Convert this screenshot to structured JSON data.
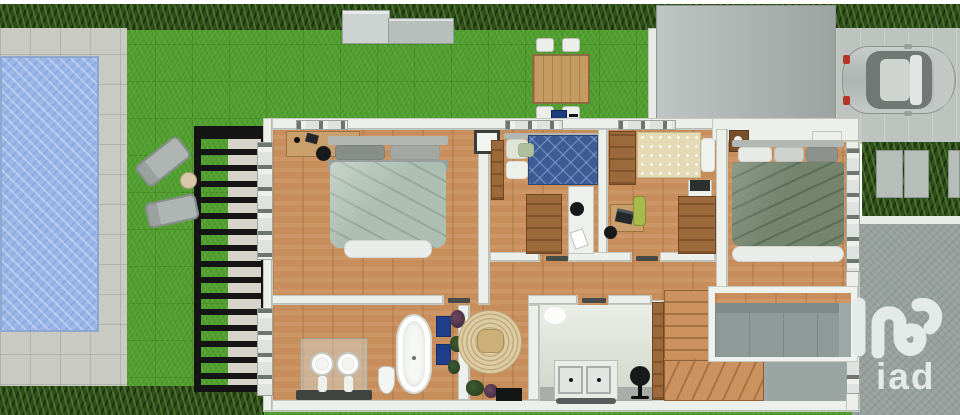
{
  "scene": {
    "kind": "3d-rendered-floor-plan",
    "description": "Top-down 3D render of an upper floor plan with garden, swimming pool, pergola, garden shed, outdoor dining set, garage roof and parked car",
    "floor_rooms": [
      {
        "name": "master-bedroom",
        "features": [
          "double-bed-sage-duvet",
          "desk",
          "black-chair",
          "wall-art",
          "left-windows"
        ]
      },
      {
        "name": "bedroom-blue",
        "features": [
          "single-bed-blue-diamond-duvet",
          "wardrobes",
          "white-desk",
          "black-chair"
        ]
      },
      {
        "name": "bedroom-beige",
        "features": [
          "single-bed-dotted-duvet",
          "wardrobes",
          "laptop",
          "green-chair",
          "nightstand"
        ]
      },
      {
        "name": "bedroom-green",
        "features": [
          "double-bed-dark-sage-duvet",
          "nightstands",
          "right-windows"
        ]
      },
      {
        "name": "bathroom",
        "features": [
          "freestanding-bathtub",
          "two-pedestal-sinks",
          "toilet",
          "blue-mats",
          "plants"
        ]
      },
      {
        "name": "hall-nook",
        "features": [
          "round-jute-rug",
          "pouf",
          "plants",
          "black-doormat"
        ]
      },
      {
        "name": "laundry-room",
        "features": [
          "washer",
          "dryer",
          "office-chair",
          "wardrobe-panel"
        ]
      },
      {
        "name": "staircase",
        "features": [
          "straight-flight",
          "winder-steps"
        ]
      },
      {
        "name": "void-over-living-room",
        "features": [
          "gray-sofa-below"
        ]
      }
    ],
    "garden_objects": [
      "swimming-pool",
      "pool-deck",
      "lawn",
      "top-hedge",
      "bottom-hedge",
      "black-pergola",
      "two-sun-loungers",
      "side-table",
      "garden-shed",
      "outdoor-dining-table",
      "four-white-chairs",
      "blue-grill",
      "garage-roof",
      "driveway",
      "parked-silver-car",
      "hedge-fence-panels"
    ]
  },
  "branding": {
    "logo_text": "iad",
    "logo_mark": "iad-swirl",
    "logo_color": "#e4eae8"
  },
  "palette": {
    "lawn_green": "#519f2e",
    "hedge_green": "#2f4c1c",
    "pool_blue": "#9cb7e7",
    "deck_gray": "#c9cbc2",
    "wood_floor": "#c78e5c",
    "wall_white": "#edf0ea",
    "wardrobe_brown": "#9c6a3a",
    "duvet_sage": "#adbfb2",
    "duvet_blue": "#3d5c95",
    "duvet_beige": "#e4dab6",
    "duvet_dark_sage": "#74846d",
    "pergola_black": "#141414",
    "driveway_dark": "#96a09c",
    "driveway_light": "#bdc3bf",
    "mat_blue": "#1f3e8a",
    "car_silver": "#c0c6c3"
  }
}
